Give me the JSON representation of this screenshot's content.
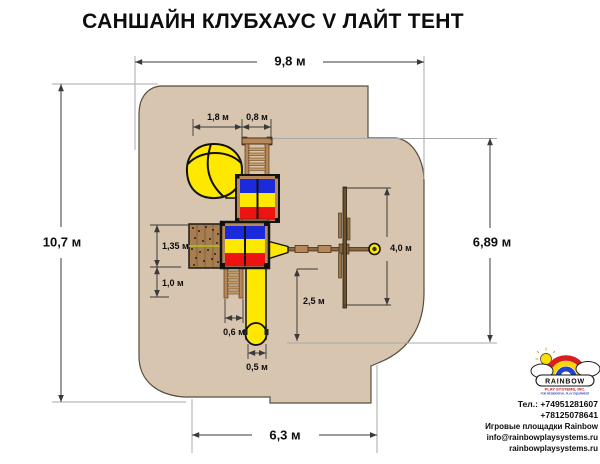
{
  "title": "САНШАЙН КЛУБХАУС V ЛАЙТ ТЕНТ",
  "plan": {
    "dims": {
      "overall_width": "9,8 м",
      "overall_depth": "10,7 м",
      "right_depth": "6,89 м",
      "bottom_width": "6,3 м",
      "spiral_span": "1,8 м",
      "ladder_span": "0,8 м",
      "wall_len": "1,35 м",
      "stairs_len": "1,0 м",
      "stairs_width": "0,6 м",
      "slide_width": "0,5 м",
      "slide_len": "2,5 м",
      "swing_len": "4,0 м"
    }
  },
  "logo": {
    "brand": "RAINBOW",
    "division": "PLAY SYSTEMS, INC.",
    "tagline": "FOR RESIDENTIAL PLAY EQUIPMENT"
  },
  "contact": {
    "phone1": "Тел.: +74951281607",
    "phone2": "+78125078641",
    "caption": "Игровые площадки Rainbow",
    "email": "info@rainbowplaysystems.ru",
    "website": "rainbowplaysystems.ru"
  },
  "colors": {
    "area_fill": "#d8c5af",
    "tarp_blue": "#1b2bdb",
    "tarp_yellow": "#ffe800",
    "tarp_red": "#ee1212",
    "wood": "#b5885a"
  }
}
